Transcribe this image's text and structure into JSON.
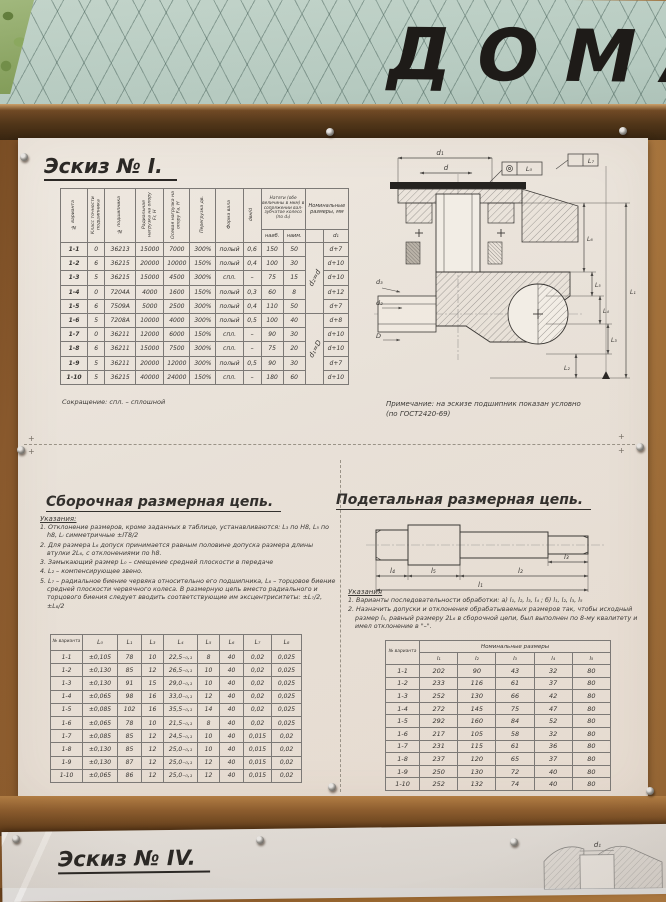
{
  "banner": {
    "text": "ДОМА"
  },
  "sheet1": {
    "sketch_title": "Эскиз № I.",
    "table1": {
      "headers_rotated": [
        "№ варианта",
        "Класс точности подшипника",
        "№ подшипника",
        "Радиальная нагрузка на опору Fr, Н",
        "Осевая нагрузка на опору Fa, Н",
        "Перегрузка дв.",
        "Форма вала",
        "dвн/d"
      ],
      "natyag_header": "Натяги (обе величины в мкм) в сопряжении вал-зубчатое колесо (по d₁)",
      "natyag_sub": [
        "наиб.",
        "наим."
      ],
      "nominal_header": "Номинальные размеры, мм",
      "d1_col": "d₁",
      "note_rows_1_5": "d₂=d",
      "note_rows_6_10": "d₁=D",
      "rows": [
        [
          "1-1",
          "0",
          "36213",
          "15000",
          "7000",
          "300%",
          "полый",
          "0,6",
          "150",
          "50",
          "d+7"
        ],
        [
          "1-2",
          "6",
          "36215",
          "20000",
          "10000",
          "150%",
          "полый",
          "0,4",
          "100",
          "30",
          "d+10"
        ],
        [
          "1-3",
          "5",
          "36215",
          "15000",
          "4500",
          "300%",
          "спл.",
          "–",
          "75",
          "15",
          "d+10"
        ],
        [
          "1-4",
          "0",
          "7204А",
          "4000",
          "1600",
          "150%",
          "полый",
          "0,3",
          "60",
          "8",
          "d+12"
        ],
        [
          "1-5",
          "6",
          "7509А",
          "5000",
          "2500",
          "300%",
          "полый",
          "0,4",
          "110",
          "50",
          "d+7"
        ],
        [
          "1-6",
          "5",
          "7208А",
          "10000",
          "4000",
          "300%",
          "полый",
          "0,5",
          "100",
          "40",
          "d+8"
        ],
        [
          "1-7",
          "0",
          "36211",
          "12000",
          "6000",
          "150%",
          "спл.",
          "–",
          "90",
          "30",
          "d+10"
        ],
        [
          "1-8",
          "6",
          "36211",
          "15000",
          "7500",
          "300%",
          "спл.",
          "–",
          "75",
          "20",
          "d+10"
        ],
        [
          "1-9",
          "5",
          "36211",
          "20000",
          "12000",
          "300%",
          "полый",
          "0,5",
          "90",
          "30",
          "d+7"
        ],
        [
          "1-10",
          "5",
          "36215",
          "40000",
          "24000",
          "150%",
          "спл.",
          "–",
          "180",
          "60",
          "d+10"
        ]
      ],
      "footnote": "Сокращение: спл. – сплошной"
    },
    "drawing1": {
      "dim_top": [
        "d₁",
        "d"
      ],
      "frame_labels": [
        "L₀",
        "L₇"
      ],
      "left_labels": [
        "d₃",
        "d₂",
        "D"
      ],
      "right_labels": [
        "L₆",
        "L₅",
        "L₄",
        "L₃",
        "L₂",
        "L₁"
      ],
      "note_line1": "Примечание: на эскизе подшипник показан условно",
      "note_line2": "(по ГОСТ2420-69)"
    },
    "assembly": {
      "title": "Сборочная размерная цепь.",
      "notes_label": "Указания:",
      "notes": [
        "1. Отклонение размеров, кроме заданных в таблице, устанавливаются: L₃ по Н8, L₅ по h8, Lᵢ симметричные ±IT8/2",
        "2. Для размера L₆ допуск принимается равным половине допуска размера длины втулки 2L₆, с отклонениями по h8.",
        "3. Замыкающий размер L₀ – смещение средней плоскости в передаче",
        "4. L₂ – компенсирующее звено.",
        "5. L₇ – радиальное биение червяка относительно его подшипника, L₈ – торцовое биение средней плоскости червячного колеса. В размерную цепь вместо радиального и торцового биения следует вводить соответствующие им эксцентриситеты: ±L₇/2, ±L₈/2"
      ],
      "table": {
        "headers": [
          "№ варианта",
          "L₀",
          "L₁",
          "L₃",
          "L₄",
          "L₅",
          "L₆",
          "L₇",
          "L₈"
        ],
        "rows": [
          [
            "1-1",
            "±0,105",
            "78",
            "10",
            "22,5₋₀,₁",
            "8",
            "40",
            "0,02",
            "0,025"
          ],
          [
            "1-2",
            "±0,130",
            "85",
            "12",
            "26,5₋₀,₁",
            "10",
            "40",
            "0,02",
            "0,025"
          ],
          [
            "1-3",
            "±0,130",
            "91",
            "15",
            "29,0₋₀,₁",
            "10",
            "40",
            "0,02",
            "0,025"
          ],
          [
            "1-4",
            "±0,065",
            "98",
            "16",
            "33,0₋₀,₁",
            "12",
            "40",
            "0,02",
            "0,025"
          ],
          [
            "1-5",
            "±0,085",
            "102",
            "16",
            "35,5₋₀,₁",
            "14",
            "40",
            "0,02",
            "0,025"
          ],
          [
            "1-6",
            "±0,065",
            "78",
            "10",
            "21,5₋₀,₁",
            "8",
            "40",
            "0,02",
            "0,025"
          ],
          [
            "1-7",
            "±0,085",
            "85",
            "12",
            "24,5₋₀,₁",
            "10",
            "40",
            "0,015",
            "0,02"
          ],
          [
            "1-8",
            "±0,130",
            "85",
            "12",
            "25,0₋₀,₁",
            "10",
            "40",
            "0,015",
            "0,02"
          ],
          [
            "1-9",
            "±0,130",
            "87",
            "12",
            "25,0₋₀,₁",
            "12",
            "40",
            "0,015",
            "0,02"
          ],
          [
            "1-10",
            "±0,065",
            "86",
            "12",
            "25,0₋₀,₁",
            "12",
            "40",
            "0,015",
            "0,02"
          ]
        ]
      }
    },
    "detail": {
      "title": "Подетальная размерная цепь.",
      "shaft_dims": [
        "l₄",
        "l₅",
        "l₂",
        "l₃",
        "l₁"
      ],
      "notes_label": "Указания",
      "notes": [
        "1. Варианты последовательности обработки: а) l₁, l₂, l₃, l₄ ;  б) l₁, l₂, l₃, l₅",
        "2. Назначить допуски и отклонения обрабатываемых размеров так, чтобы исходный размер l₅, равный размеру 2L₆ в сборочной цепи, был выполнен по 8-му квалитету и имел отклонение в \"–\"."
      ],
      "table": {
        "corner_header": "№ варианта",
        "group_header": "Номинальные размеры",
        "headers": [
          "l₁",
          "l₂",
          "l₃",
          "l₄",
          "l₅"
        ],
        "rows": [
          [
            "1-1",
            "202",
            "90",
            "43",
            "32",
            "80"
          ],
          [
            "1-2",
            "233",
            "116",
            "61",
            "37",
            "80"
          ],
          [
            "1-3",
            "252",
            "130",
            "66",
            "42",
            "80"
          ],
          [
            "1-4",
            "272",
            "145",
            "75",
            "47",
            "80"
          ],
          [
            "1-5",
            "292",
            "160",
            "84",
            "52",
            "80"
          ],
          [
            "1-6",
            "217",
            "105",
            "58",
            "32",
            "80"
          ],
          [
            "1-7",
            "231",
            "115",
            "61",
            "36",
            "80"
          ],
          [
            "1-8",
            "237",
            "120",
            "65",
            "37",
            "80"
          ],
          [
            "1-9",
            "250",
            "130",
            "72",
            "40",
            "80"
          ],
          [
            "1-10",
            "252",
            "132",
            "74",
            "40",
            "80"
          ]
        ]
      }
    }
  },
  "sheet2": {
    "sketch_title": "Эскиз № IV.",
    "partial_label": "d₁"
  }
}
